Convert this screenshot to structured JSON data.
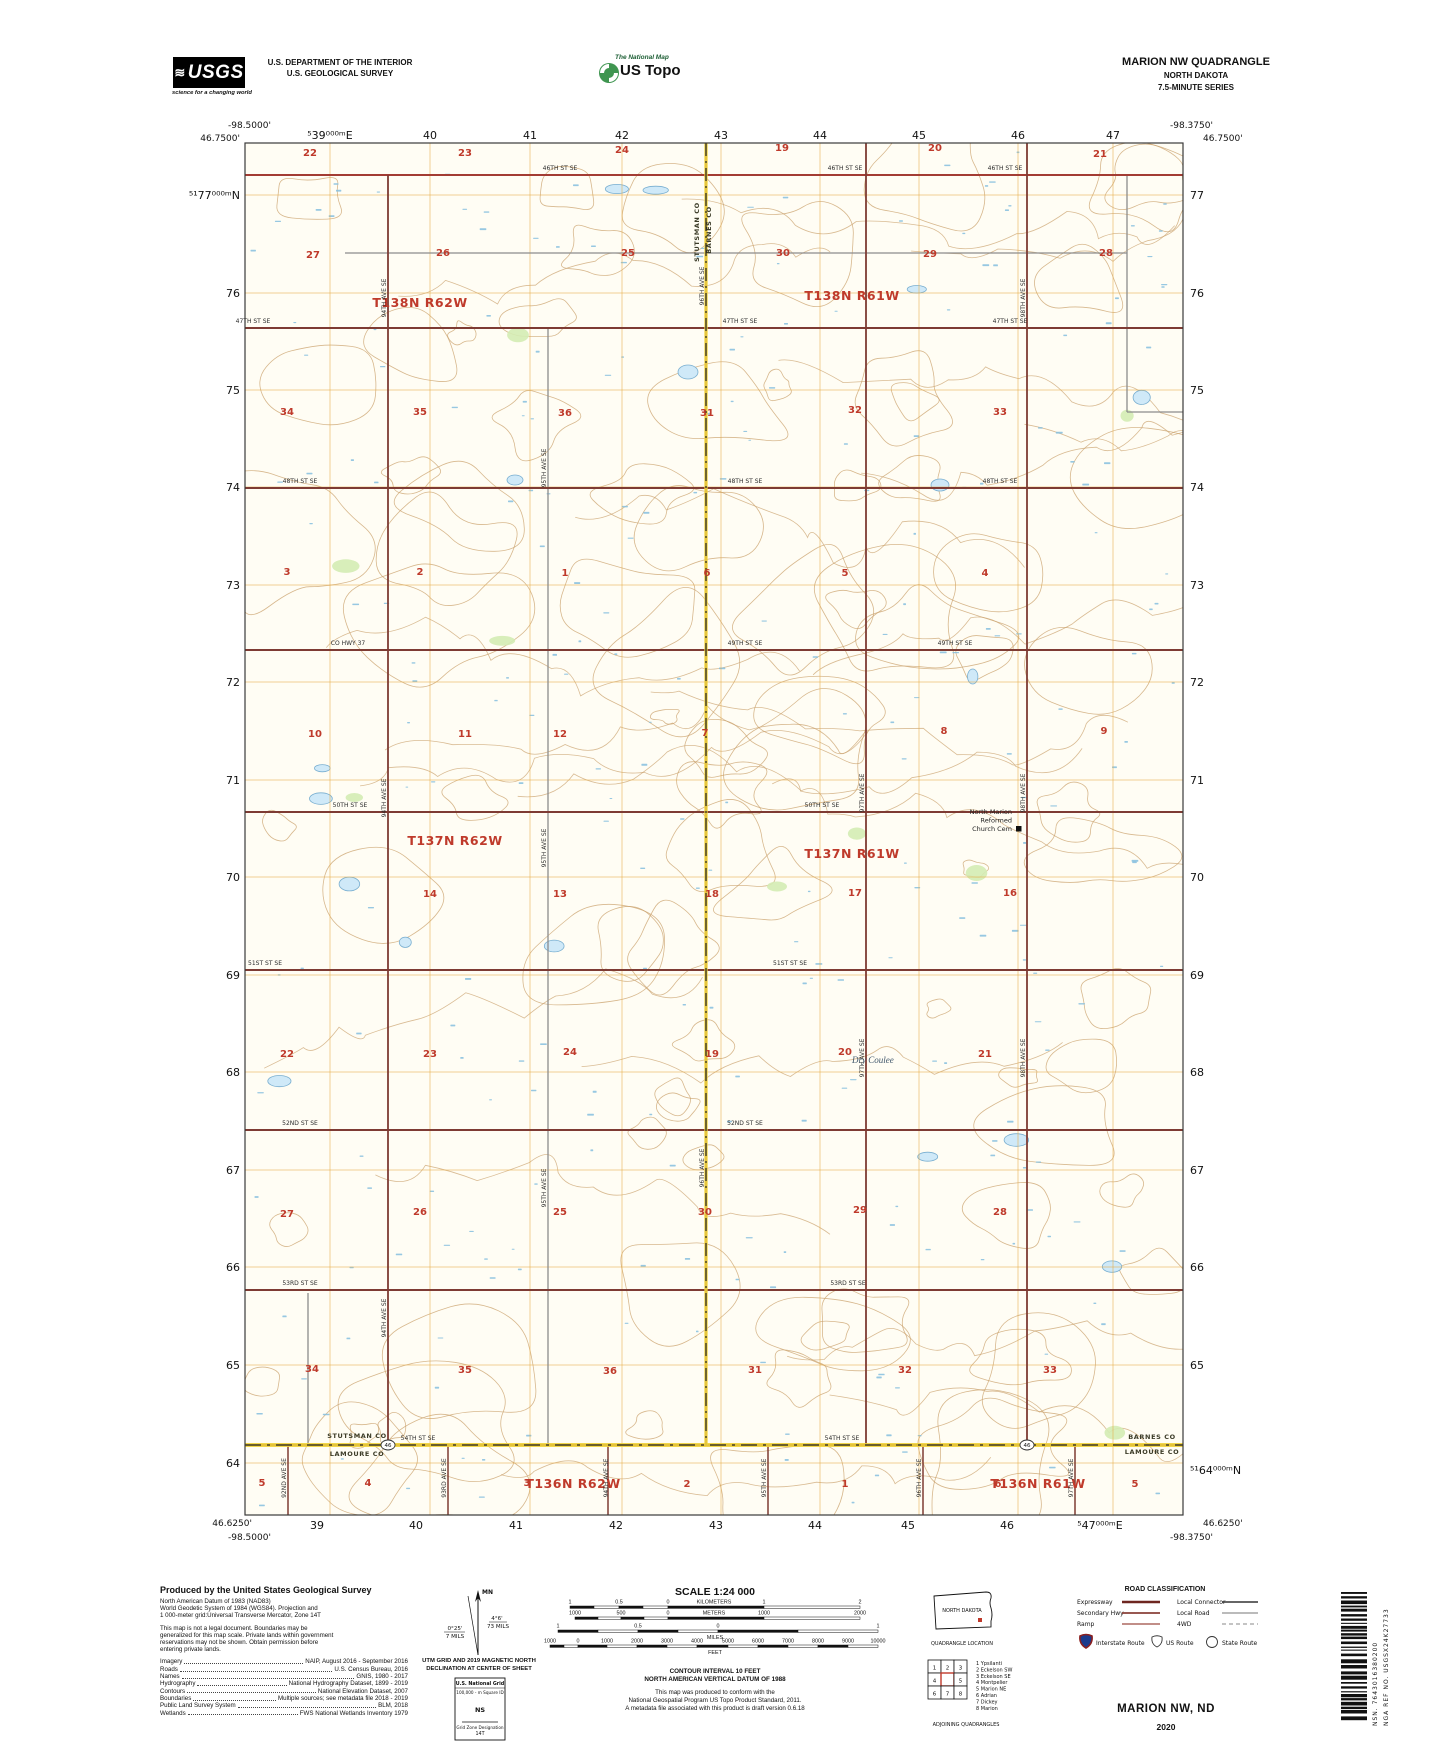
{
  "header": {
    "usgs": "USGS",
    "usgs_tagline": "science for a changing world",
    "dept1": "U.S. DEPARTMENT OF THE INTERIOR",
    "dept2": "U.S. GEOLOGICAL SURVEY",
    "natmap": "The National Map",
    "ustopo": "US Topo",
    "quad": "MARION NW QUADRANGLE",
    "state": "NORTH DAKOTA",
    "series": "7.5-MINUTE SERIES"
  },
  "map": {
    "corners": {
      "tl_lon": "-98.5000'",
      "tl_lat": "46.7500'",
      "tr_lon": "-98.3750'",
      "tr_lat": "46.7500'",
      "bl_lat": "46.6250'",
      "bl_lon": "-98.5000'",
      "br_lat": "46.6250'",
      "br_lon": "-98.3750'"
    },
    "grid_top": [
      [
        "⁵39⁰⁰⁰ᵐE",
        330
      ],
      [
        "40",
        430
      ],
      [
        "41",
        530
      ],
      [
        "42",
        622
      ],
      [
        "43",
        721
      ],
      [
        "44",
        820
      ],
      [
        "45",
        919
      ],
      [
        "46",
        1018
      ],
      [
        "47",
        1113
      ]
    ],
    "grid_bottom": [
      [
        "39",
        317
      ],
      [
        "40",
        416
      ],
      [
        "41",
        516
      ],
      [
        "42",
        616
      ],
      [
        "43",
        716
      ],
      [
        "44",
        815
      ],
      [
        "45",
        908
      ],
      [
        "46",
        1007
      ],
      [
        "⁵47⁰⁰⁰ᵐE",
        1100
      ]
    ],
    "grid_left": [
      [
        "⁵¹77⁰⁰⁰ᵐN",
        195
      ],
      [
        "76",
        293
      ],
      [
        "75",
        390
      ],
      [
        "74",
        487
      ],
      [
        "73",
        585
      ],
      [
        "72",
        682
      ],
      [
        "71",
        780
      ],
      [
        "70",
        877
      ],
      [
        "69",
        975
      ],
      [
        "68",
        1072
      ],
      [
        "67",
        1170
      ],
      [
        "66",
        1267
      ],
      [
        "65",
        1365
      ],
      [
        "64",
        1463
      ]
    ],
    "grid_right": [
      [
        "77",
        195
      ],
      [
        "76",
        293
      ],
      [
        "75",
        390
      ],
      [
        "74",
        487
      ],
      [
        "73",
        585
      ],
      [
        "72",
        682
      ],
      [
        "71",
        780
      ],
      [
        "70",
        877
      ],
      [
        "69",
        975
      ],
      [
        "68",
        1072
      ],
      [
        "67",
        1170
      ],
      [
        "66",
        1267
      ],
      [
        "65",
        1365
      ],
      [
        "⁵¹64⁰⁰⁰ᵐN",
        1470
      ]
    ],
    "townships": [
      [
        "T138N R62W",
        420,
        307
      ],
      [
        "T138N R61W",
        852,
        300
      ],
      [
        "T137N R62W",
        455,
        845
      ],
      [
        "T137N R61W",
        852,
        858
      ],
      [
        "T136N R62W",
        573,
        1488
      ],
      [
        "T136N R61W",
        1038,
        1488
      ]
    ],
    "sections": [
      [
        "22",
        310,
        156
      ],
      [
        "23",
        465,
        156
      ],
      [
        "24",
        622,
        153
      ],
      [
        "19",
        782,
        151
      ],
      [
        "20",
        935,
        151
      ],
      [
        "21",
        1100,
        157
      ],
      [
        "27",
        313,
        258
      ],
      [
        "26",
        443,
        256
      ],
      [
        "25",
        628,
        256
      ],
      [
        "30",
        783,
        256
      ],
      [
        "29",
        930,
        257
      ],
      [
        "28",
        1106,
        256
      ],
      [
        "34",
        287,
        415
      ],
      [
        "35",
        420,
        415
      ],
      [
        "36",
        565,
        416
      ],
      [
        "31",
        707,
        416
      ],
      [
        "32",
        855,
        413
      ],
      [
        "33",
        1000,
        415
      ],
      [
        "3",
        287,
        575
      ],
      [
        "2",
        420,
        575
      ],
      [
        "1",
        565,
        576
      ],
      [
        "6",
        707,
        576
      ],
      [
        "5",
        845,
        576
      ],
      [
        "4",
        985,
        576
      ],
      [
        "10",
        315,
        737
      ],
      [
        "11",
        465,
        737
      ],
      [
        "12",
        560,
        737
      ],
      [
        "7",
        705,
        736
      ],
      [
        "8",
        944,
        734
      ],
      [
        "9",
        1104,
        734
      ],
      [
        "14",
        430,
        897
      ],
      [
        "13",
        560,
        897
      ],
      [
        "18",
        712,
        897
      ],
      [
        "17",
        855,
        896
      ],
      [
        "16",
        1010,
        896
      ],
      [
        "22",
        287,
        1057
      ],
      [
        "23",
        430,
        1057
      ],
      [
        "24",
        570,
        1055
      ],
      [
        "19",
        712,
        1057
      ],
      [
        "20",
        845,
        1055
      ],
      [
        "21",
        985,
        1057
      ],
      [
        "27",
        287,
        1217
      ],
      [
        "26",
        420,
        1215
      ],
      [
        "25",
        560,
        1215
      ],
      [
        "30",
        705,
        1215
      ],
      [
        "29",
        860,
        1213
      ],
      [
        "28",
        1000,
        1215
      ],
      [
        "34",
        312,
        1372
      ],
      [
        "35",
        465,
        1373
      ],
      [
        "36",
        610,
        1374
      ],
      [
        "31",
        755,
        1373
      ],
      [
        "32",
        905,
        1373
      ],
      [
        "33",
        1050,
        1373
      ],
      [
        "5",
        262,
        1486
      ],
      [
        "4",
        368,
        1486
      ],
      [
        "3",
        527,
        1486
      ],
      [
        "2",
        687,
        1487
      ],
      [
        "1",
        845,
        1487
      ],
      [
        "6",
        998,
        1487
      ],
      [
        "5",
        1135,
        1487
      ]
    ],
    "road_labels_h": [
      [
        "46TH ST SE",
        560,
        170
      ],
      [
        "46TH ST SE",
        845,
        170
      ],
      [
        "46TH ST SE",
        1005,
        170
      ],
      [
        "47TH ST SE",
        253,
        323
      ],
      [
        "47TH ST SE",
        740,
        323
      ],
      [
        "47TH ST SE",
        1010,
        323
      ],
      [
        "48TH ST SE",
        300,
        483
      ],
      [
        "48TH ST SE",
        745,
        483
      ],
      [
        "48TH ST SE",
        1000,
        483
      ],
      [
        "CO HWY 37",
        348,
        645
      ],
      [
        "49TH ST SE",
        745,
        645
      ],
      [
        "49TH ST SE",
        955,
        645
      ],
      [
        "50TH ST SE",
        350,
        807
      ],
      [
        "50TH ST SE",
        822,
        807
      ],
      [
        "51ST ST SE",
        265,
        965
      ],
      [
        "51ST ST SE",
        790,
        965
      ],
      [
        "52ND ST SE",
        300,
        1125
      ],
      [
        "52ND ST SE",
        745,
        1125
      ],
      [
        "53RD ST SE",
        300,
        1285
      ],
      [
        "53RD ST SE",
        848,
        1285
      ],
      [
        "54TH ST SE",
        418,
        1440
      ],
      [
        "54TH ST SE",
        842,
        1440
      ]
    ],
    "road_labels_v": [
      [
        "94TH AVE SE",
        388,
        300
      ],
      [
        "94TH AVE SE",
        388,
        800
      ],
      [
        "94TH AVE SE",
        388,
        1320
      ],
      [
        "95TH AVE SE",
        548,
        470
      ],
      [
        "95TH AVE SE",
        548,
        850
      ],
      [
        "95TH AVE SE",
        548,
        1190
      ],
      [
        "96TH AVE SE",
        706,
        288
      ],
      [
        "96TH AVE SE",
        706,
        1170
      ],
      [
        "97TH AVE SE",
        866,
        795
      ],
      [
        "97TH AVE SE",
        866,
        1060
      ],
      [
        "98TH AVE SE",
        1027,
        300
      ],
      [
        "98TH AVE SE",
        1027,
        795
      ],
      [
        "98TH AVE SE",
        1027,
        1060
      ],
      [
        "92ND AVE SE",
        288,
        1480
      ],
      [
        "93RD AVE SE",
        448,
        1480
      ],
      [
        "94TH AVE SE",
        610,
        1480
      ],
      [
        "95TH AVE SE",
        768,
        1480
      ],
      [
        "96TH AVE SE",
        923,
        1480
      ],
      [
        "97TH AVE SE",
        1075,
        1480
      ]
    ],
    "county_vertical": [
      [
        "STUTSMAN CO",
        699,
        232
      ],
      [
        "BARNES CO",
        711,
        230
      ]
    ],
    "county_bottom": [
      [
        "STUTSMAN CO",
        357,
        1438
      ],
      [
        "LAMOURE CO",
        357,
        1456
      ],
      [
        "BARNES CO",
        1152,
        1439
      ],
      [
        "LAMOURE CO",
        1152,
        1454
      ]
    ],
    "church_lines": [
      "North Marion",
      "Reformed",
      "Church Cem"
    ],
    "church_x": 1012,
    "church_y": 814,
    "coulee": "Dry Coulee",
    "coulee_x": 852,
    "coulee_y": 1063,
    "shields": [
      [
        "46",
        388,
        1445
      ],
      [
        "46",
        1027,
        1445
      ]
    ]
  },
  "footer": {
    "produced_title": "Produced by the United States Geological Survey",
    "datum_lines": [
      "North American Datum of 1983 (NAD83)",
      "World Geodetic System of 1984 (WGS84).  Projection and",
      "1 000-meter grid:Universal Transverse Mercator, Zone 14T"
    ],
    "legal_lines": [
      "This map is not a legal document. Boundaries may be",
      "generalized for this map scale. Private lands within government",
      "reservations may not be shown. Obtain permission before",
      "entering private lands."
    ],
    "credits": [
      [
        "Imagery",
        "NAIP, August 2016 - September 2016"
      ],
      [
        "Roads",
        "U.S. Census Bureau, 2016"
      ],
      [
        "Names",
        "GNIS, 1980 - 2017"
      ],
      [
        "Hydrography",
        "National Hydrography Dataset, 1899 - 2019"
      ],
      [
        "Contours",
        "National Elevation Dataset, 2007"
      ],
      [
        "Boundaries",
        "Multiple sources; see metadata file 2018 - 2019"
      ],
      [
        "Public Land Survey System",
        "BLM, 2018"
      ],
      [
        "Wetlands",
        "FWS National Wetlands Inventory 1979"
      ]
    ],
    "declination": {
      "mn": "MN",
      "gn_deg": "0°25'",
      "gn_mils": "7 MILS",
      "mn_deg": "4°6'",
      "mn_mils": "73 MILS",
      "caption1": "UTM GRID AND 2019 MAGNETIC NORTH",
      "caption2": "DECLINATION AT CENTER OF SHEET"
    },
    "natgrid": {
      "title": "U.S. National Grid",
      "sq_label": "100,000 - m Square ID",
      "sq": "NS",
      "zone_label": "Grid Zone Designation",
      "zone": "14T"
    },
    "scale_title": "SCALE 1:24 000",
    "scalebars": [
      {
        "y": 1606,
        "ticks": [
          570,
          594,
          619,
          643,
          668,
          764,
          860
        ],
        "labels": [
          [
            "1",
            570
          ],
          [
            "0.5",
            619
          ],
          [
            "0",
            668
          ],
          [
            "KILOMETERS",
            714
          ],
          [
            "1",
            764
          ],
          [
            "2",
            860
          ]
        ]
      },
      {
        "y": 1617,
        "ticks": [
          575,
          598,
          621,
          644,
          668,
          764,
          860
        ],
        "labels": [
          [
            "1000",
            575
          ],
          [
            "500",
            621
          ],
          [
            "0",
            668
          ],
          [
            "METERS",
            714
          ],
          [
            "1000",
            764
          ],
          [
            "2000",
            860
          ]
        ]
      },
      {
        "y": 1630,
        "ticks": [
          558,
          598,
          638,
          678,
          718,
          798,
          878
        ],
        "labels": [
          [
            "1",
            558
          ],
          [
            "0.5",
            638
          ],
          [
            "0",
            718
          ],
          [
            "1",
            878
          ]
        ],
        "unit": [
          "MILES",
          715
        ]
      },
      {
        "y": 1645,
        "ticks": [
          550,
          564,
          578,
          607,
          637,
          667,
          697,
          728,
          758,
          788,
          818,
          848,
          878
        ],
        "labels": [
          [
            "1000",
            550
          ],
          [
            "0",
            578
          ],
          [
            "1000",
            607
          ],
          [
            "2000",
            637
          ],
          [
            "3000",
            667
          ],
          [
            "4000",
            697
          ],
          [
            "5000",
            728
          ],
          [
            "6000",
            758
          ],
          [
            "7000",
            788
          ],
          [
            "8000",
            818
          ],
          [
            "9000",
            848
          ],
          [
            "10000",
            878
          ]
        ],
        "unit": [
          "FEET",
          715
        ]
      }
    ],
    "contour1": "CONTOUR INTERVAL 10 FEET",
    "contour2": "NORTH AMERICAN VERTICAL DATUM OF 1988",
    "conformance": [
      "This map was produced to conform with the",
      "National Geospatial Program US Topo Product Standard, 2011.",
      "A metadata file associated with this product is draft version 0.6.18"
    ],
    "state_name": "NORTH DAKOTA",
    "quad_location": "QUADRANGLE LOCATION",
    "adjoining_cells": [
      "1",
      "2",
      "3",
      "4",
      "",
      "5",
      "6",
      "7",
      "8"
    ],
    "adjoining_legend": [
      "1 Ypsilanti",
      "2 Eckelson SW",
      "3 Eckelson SE",
      "4 Montpelier",
      "5 Marion NE",
      "6 Adrian",
      "7 Dickey",
      "8 Marion"
    ],
    "adjoining_caption": "ADJOINING QUADRANGLES",
    "roadclass_title": "ROAD CLASSIFICATION",
    "roadclass": [
      [
        "Expressway",
        "Local Connector"
      ],
      [
        "Secondary Hwy",
        "Local Road"
      ],
      [
        "Ramp",
        "4WD"
      ]
    ],
    "route_legend": [
      "Interstate Route",
      "US Route",
      "State Route"
    ],
    "sheet_title": "MARION NW,  ND",
    "year": "2020",
    "nsn": "NSN. 7643016380200",
    "nga": "NGA REF NO. USGSX24K27733"
  }
}
